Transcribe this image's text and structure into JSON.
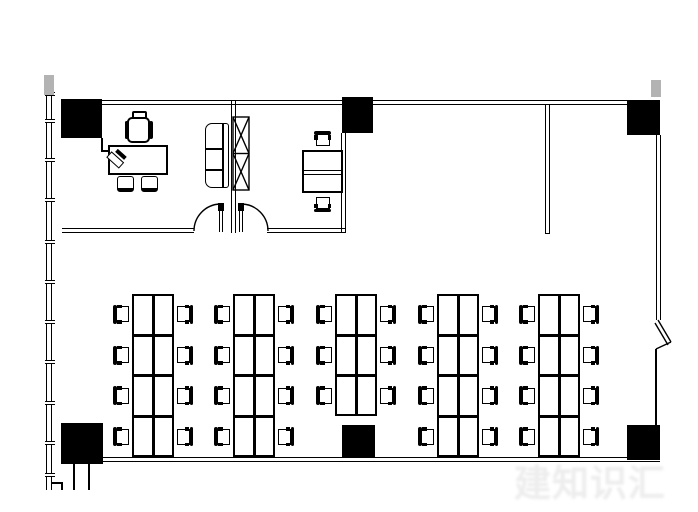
{
  "watermark": {
    "text": "建知识汇",
    "color": "#ededed"
  },
  "colors": {
    "line": "#000000",
    "column_fill": "#000000",
    "mullion_cap": "#b3b3b3",
    "background": "#ffffff"
  },
  "canvas": {
    "width": 698,
    "height": 512
  },
  "plan": {
    "walls_double_h": [
      {
        "name": "exterior-wall-top",
        "x": 62,
        "y": 100,
        "w": 598
      },
      {
        "name": "exterior-wall-bottom",
        "x": 62,
        "y": 457,
        "w": 598
      },
      {
        "name": "office1-south-wall",
        "x": 62,
        "y": 228,
        "w": 132
      },
      {
        "name": "office2-south-wall",
        "x": 267,
        "y": 228,
        "w": 78
      }
    ],
    "walls_double_v": [
      {
        "name": "office-partition-wall",
        "x": 231,
        "y": 100,
        "h": 133
      },
      {
        "name": "office2-east-wall",
        "x": 341,
        "y": 133,
        "h": 100
      },
      {
        "name": "screen-partition-wall",
        "x": 545,
        "y": 105,
        "h": 129,
        "closed_end": true
      },
      {
        "name": "exterior-wall-right-upper",
        "x": 656,
        "y": 135,
        "h": 185
      }
    ],
    "walls_single": [
      {
        "name": "exterior-wall-right-lower",
        "x": 655,
        "y": 349,
        "w": 1.5,
        "h": 76
      },
      {
        "name": "curtain-wall-outer-line",
        "x": 46,
        "y": 76,
        "w": 1.3,
        "h": 414
      },
      {
        "name": "curtain-wall-inner-line",
        "x": 51,
        "y": 76,
        "w": 1.3,
        "h": 414
      },
      {
        "name": "wall-stub-left-a",
        "x": 73,
        "y": 464,
        "w": 1.5,
        "h": 26
      },
      {
        "name": "wall-stub-left-b",
        "x": 88,
        "y": 464,
        "w": 1.5,
        "h": 26
      },
      {
        "name": "curtain-wall-step-h",
        "x": 52,
        "y": 482,
        "w": 11,
        "h": 1.5
      },
      {
        "name": "curtain-wall-step-v",
        "x": 61,
        "y": 482,
        "w": 1.5,
        "h": 8
      },
      {
        "name": "office1-cabinet-line-v",
        "x": 101,
        "y": 138,
        "w": 1.5,
        "h": 13
      },
      {
        "name": "office1-cabinet-line-h",
        "x": 101,
        "y": 150,
        "w": 8,
        "h": 1.5
      }
    ],
    "columns": [
      {
        "name": "column-top-left",
        "x": 61,
        "y": 99,
        "w": 41,
        "h": 39
      },
      {
        "name": "column-top-middle",
        "x": 342,
        "y": 97,
        "w": 31,
        "h": 36
      },
      {
        "name": "column-top-right",
        "x": 627,
        "y": 101,
        "w": 33,
        "h": 34
      },
      {
        "name": "column-bottom-left",
        "x": 61,
        "y": 423,
        "w": 42,
        "h": 41
      },
      {
        "name": "column-bottom-middle",
        "x": 342,
        "y": 425,
        "w": 33,
        "h": 33
      },
      {
        "name": "column-bottom-right",
        "x": 627,
        "y": 425,
        "w": 33,
        "h": 35
      }
    ],
    "mullion_caps": [
      {
        "name": "mullion-cap-top-left",
        "x": 44,
        "y": 75,
        "w": 10,
        "h": 20
      },
      {
        "name": "mullion-cap-top-right",
        "x": 651,
        "y": 80,
        "w": 10,
        "h": 17
      }
    ],
    "curtain_ticks": {
      "x": 44.5,
      "w": 10,
      "h": 4,
      "ys": [
        92,
        119,
        158,
        198,
        240,
        280,
        320,
        360,
        401,
        441,
        473
      ]
    },
    "doors": [
      {
        "name": "door-office1",
        "jamb": {
          "x": 218,
          "y": 203,
          "w": 6,
          "h": 7.5
        },
        "leaf": {
          "x": 219,
          "y": 210,
          "w": 4,
          "h": 22
        },
        "arc": "M 194 231 A 27 27 0 0 1 220 204"
      },
      {
        "name": "door-office2",
        "jamb": {
          "x": 238,
          "y": 203,
          "w": 6,
          "h": 7.5
        },
        "leaf": {
          "x": 239,
          "y": 210,
          "w": 4,
          "h": 22
        },
        "arc": "M 268 231 A 27 27 0 0 0 242 204"
      }
    ],
    "shaft": {
      "name": "hatched-shaft",
      "x": 233,
      "y": 117,
      "w": 16,
      "h": 73
    },
    "sofa": {
      "name": "office1-sofa",
      "x": 205,
      "y": 123,
      "w": 24,
      "h": 65,
      "back_offset": 16,
      "cushion_ys": [
        24,
        45
      ]
    },
    "office2_desk": {
      "name": "office2-desk",
      "x": 302,
      "y": 150,
      "w": 41,
      "h": 43,
      "band_top": 18,
      "chairs": [
        {
          "x": 314,
          "y": 131,
          "facing": "down"
        },
        {
          "x": 314,
          "y": 196,
          "facing": "up"
        }
      ]
    },
    "executive": {
      "desk": {
        "name": "executive-desk",
        "x": 108,
        "y": 145,
        "w": 60,
        "h": 30
      },
      "phone": {
        "x": 111,
        "y": 147,
        "rot": -48
      },
      "star": {
        "cx": 155,
        "cy": 164,
        "r": 8
      },
      "chair": {
        "head": {
          "x": 132,
          "y": 111,
          "w": 15,
          "h": 8
        },
        "body": {
          "x": 127,
          "y": 117,
          "w": 23,
          "h": 26
        },
        "arm_l": {
          "x": 124.5,
          "y": 121,
          "w": 3.5,
          "h": 18
        },
        "arm_r": {
          "x": 149,
          "y": 121,
          "w": 3.5,
          "h": 18
        }
      },
      "guest_chairs": [
        {
          "x": 117,
          "y": 176,
          "w": 17,
          "h": 16
        },
        {
          "x": 141,
          "y": 176,
          "w": 17,
          "h": 16
        }
      ]
    },
    "right_notch_lines": [
      [
        658,
        320,
        671,
        342
      ],
      [
        655,
        323,
        668,
        345
      ],
      [
        671,
        342,
        656,
        349
      ]
    ],
    "clusters": {
      "desk_width": 42,
      "row_height": 40.75,
      "top_y": 294,
      "chair": {
        "w": 17,
        "h": 19,
        "gap": 2
      },
      "items": [
        {
          "name": "workstation-cluster-1",
          "x": 132,
          "rows": 4
        },
        {
          "name": "workstation-cluster-2",
          "x": 233,
          "rows": 4
        },
        {
          "name": "workstation-cluster-3",
          "x": 335,
          "rows": 3
        },
        {
          "name": "workstation-cluster-4",
          "x": 437,
          "rows": 4
        },
        {
          "name": "workstation-cluster-5",
          "x": 538,
          "rows": 4
        }
      ]
    }
  }
}
